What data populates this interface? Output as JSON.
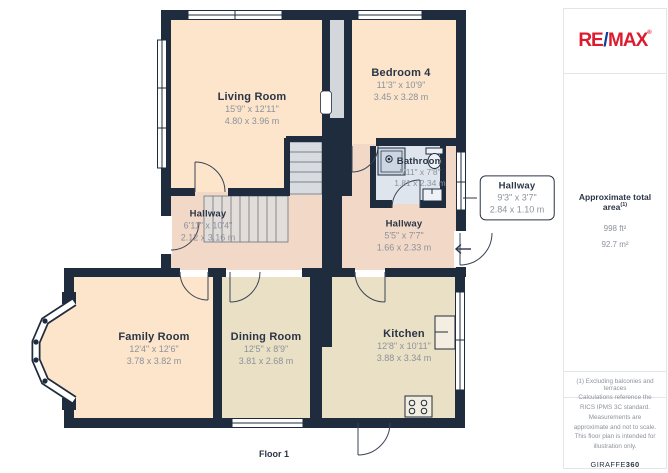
{
  "floor": {
    "label": "Floor 1"
  },
  "rooms": {
    "living": {
      "name": "Living Room",
      "imperial": "15'9\" x 12'11\"",
      "metric": "4.80 x 3.96 m"
    },
    "bedroom4": {
      "name": "Bedroom 4",
      "imperial": "11'3\" x 10'9\"",
      "metric": "3.45 x 3.28 m"
    },
    "bathroom": {
      "name": "Bathroom",
      "imperial": "5'11\" x 7'8\"",
      "metric": "1.81 x 2.34 m"
    },
    "hallway_callout": {
      "name": "Hallway",
      "imperial": "9'3\" x 3'7\"",
      "metric": "2.84 x 1.10 m"
    },
    "hallway_main": {
      "name": "Hallway",
      "imperial": "6'11\" x 10'4\"",
      "metric": "2.12 x 3.16 m"
    },
    "hallway_small": {
      "name": "Hallway",
      "imperial": "5'5\" x 7'7\"",
      "metric": "1.66 x 2.33 m"
    },
    "family": {
      "name": "Family Room",
      "imperial": "12'4\" x 12'6\"",
      "metric": "3.78 x 3.82 m"
    },
    "dining": {
      "name": "Dining Room",
      "imperial": "12'5\" x 8'9\"",
      "metric": "3.81 x 2.68 m"
    },
    "kitchen": {
      "name": "Kitchen",
      "imperial": "12'8\" x 10'11\"",
      "metric": "3.88 x 3.34 m"
    }
  },
  "branding": {
    "re": "RE",
    "slash": "/",
    "max": "MAX",
    "reg": "®"
  },
  "sidebar": {
    "area_title": "Approximate total area",
    "area_sup": "(1)",
    "area_ft": "998 ft²",
    "area_m": "92.7 m²",
    "note": "(1) Excluding balconies and terraces",
    "disclaimer": "Calculations reference the RICS IPMS 3C standard. Measurements are approximate and not to scale. This floor plan is intended for illustration only.",
    "brand_name": "GIRAFFE",
    "brand_suffix": "360"
  },
  "colors": {
    "wall": "#1f2c3e",
    "room_peach": "#fce5ca",
    "hall_pink": "#f2d8c6",
    "room_tan": "#e9e0c5",
    "bath_blue": "#dfe5ec",
    "stair_gray": "#d8dbdf",
    "remax_red": "#dc1c2e",
    "remax_blue": "#0a3f9d"
  }
}
